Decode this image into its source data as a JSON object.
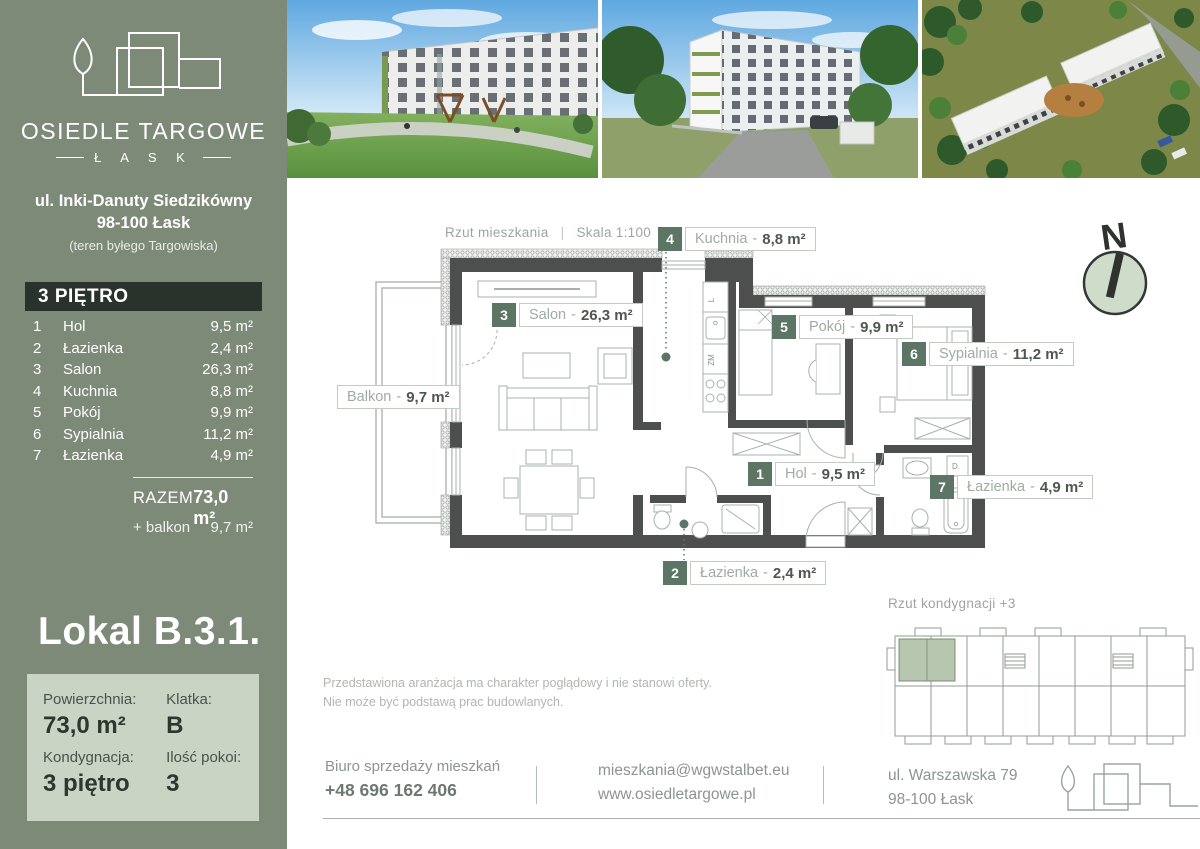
{
  "brand": {
    "name": "OSIEDLE TARGOWE",
    "city": "Ł A S K",
    "address1": "ul. Inki-Danuty Siedzikówny",
    "address2": "98-100 Łask",
    "address3": "(teren byłego Targowiska)"
  },
  "floor_table": {
    "header": "3 PIĘTRO",
    "rows": [
      {
        "num": "1",
        "name": "Hol",
        "area": "9,5 m²"
      },
      {
        "num": "2",
        "name": "Łazienka",
        "area": "2,4 m²"
      },
      {
        "num": "3",
        "name": "Salon",
        "area": "26,3 m²"
      },
      {
        "num": "4",
        "name": "Kuchnia",
        "area": "8,8 m²"
      },
      {
        "num": "5",
        "name": "Pokój",
        "area": "9,9 m²"
      },
      {
        "num": "6",
        "name": "Sypialnia",
        "area": "11,2 m²"
      },
      {
        "num": "7",
        "name": "Łazienka",
        "area": "4,9 m²"
      }
    ],
    "total_label": "RAZEM",
    "total_value": "73,0 m²",
    "balcony_label": "+ balkon",
    "balcony_value": "9,7 m²"
  },
  "unit": {
    "title": "Lokal B.3.1.",
    "fields": [
      {
        "label": "Powierzchnia:",
        "value": "73,0 m²"
      },
      {
        "label": "Klatka:",
        "value": "B"
      },
      {
        "label": "Kondygnacja:",
        "value": "3 piętro"
      },
      {
        "label": "Ilość pokoi:",
        "value": "3"
      }
    ]
  },
  "plan": {
    "caption": "Rzut mieszkania",
    "pipe": "|",
    "scale": "Skala 1:100",
    "sep": "-",
    "balcony": {
      "name": "Balkon",
      "area": "9,7 m²"
    },
    "appliances": {
      "fridge": "L",
      "dishwasher": "ZM",
      "washer": "D."
    }
  },
  "compass": {
    "letter": "N"
  },
  "overview": {
    "caption": "Rzut kondygnacji +3"
  },
  "disclaimer": {
    "line1": "Przedstawiona aranżacja ma charakter poglądowy i nie stanowi oferty.",
    "line2": "Nie może być podstawą prac budowlanych."
  },
  "contact": {
    "office": "Biuro sprzedaży mieszkań",
    "phone": "+48 696 162 406",
    "email": "mieszkania@wgwstalbet.eu",
    "website": "www.osiedletargowe.pl",
    "address1": "ul. Warszawska 79",
    "address2": "98-100 Łask"
  },
  "photos": [
    {
      "name": "courtyard-playground-render"
    },
    {
      "name": "building-street-render"
    },
    {
      "name": "aerial-estate-render"
    }
  ],
  "colors": {
    "sidebar": "#7D8A78",
    "dark_bar": "#29322B",
    "accent_green": "#5C7565",
    "light_box": "#C9D4C5",
    "wall": "#4D4F4E"
  }
}
